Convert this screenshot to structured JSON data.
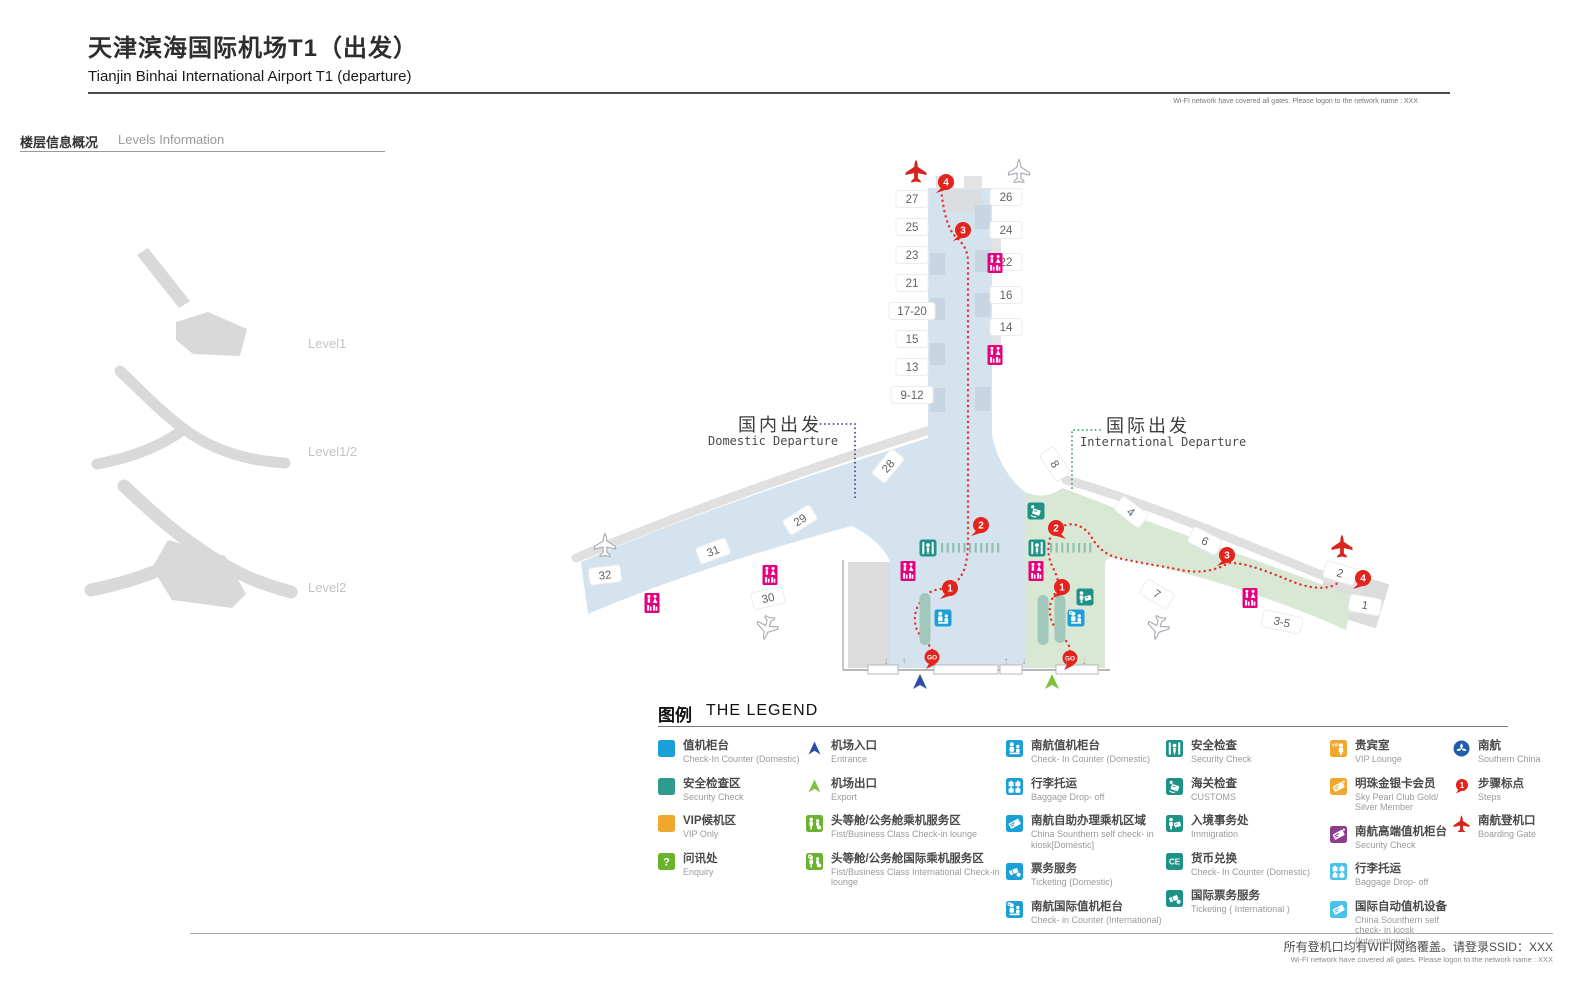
{
  "header": {
    "title_zh": "天津滨海国际机场T1（出发）",
    "title_en": "Tianjin Binhai International Airport T1 (departure)",
    "wifi_note": "Wi-FI network have covered all gates. Please logon to the network name : XXX"
  },
  "levels": {
    "heading_zh": "楼层信息概况",
    "heading_en": "Levels Information",
    "items": [
      {
        "label": "Level1"
      },
      {
        "label": "Level1/2"
      },
      {
        "label": "Level2"
      }
    ]
  },
  "map": {
    "domestic_zh": "国内出发",
    "domestic_en": "Domestic Departure",
    "international_zh": "国际出发",
    "international_en": "International Departure",
    "gates": [
      {
        "id": "27",
        "x": 912,
        "y": 199,
        "rot": 0
      },
      {
        "id": "25",
        "x": 912,
        "y": 227,
        "rot": 0
      },
      {
        "id": "23",
        "x": 912,
        "y": 255,
        "rot": 0
      },
      {
        "id": "21",
        "x": 912,
        "y": 283,
        "rot": 0
      },
      {
        "id": "17-20",
        "x": 912,
        "y": 311,
        "rot": 0,
        "w": 46
      },
      {
        "id": "15",
        "x": 912,
        "y": 339,
        "rot": 0
      },
      {
        "id": "13",
        "x": 912,
        "y": 367,
        "rot": 0
      },
      {
        "id": "9-12",
        "x": 912,
        "y": 395,
        "rot": 0,
        "w": 42
      },
      {
        "id": "26",
        "x": 1006,
        "y": 197,
        "rot": 0
      },
      {
        "id": "24",
        "x": 1006,
        "y": 230,
        "rot": 0
      },
      {
        "id": "22",
        "x": 1006,
        "y": 262,
        "rot": 0
      },
      {
        "id": "16",
        "x": 1006,
        "y": 295,
        "rot": 0
      },
      {
        "id": "14",
        "x": 1006,
        "y": 327,
        "rot": 0
      },
      {
        "id": "28",
        "x": 888,
        "y": 466,
        "rot": -50
      },
      {
        "id": "29",
        "x": 800,
        "y": 520,
        "rot": -32
      },
      {
        "id": "31",
        "x": 713,
        "y": 551,
        "rot": -20
      },
      {
        "id": "32",
        "x": 605,
        "y": 575,
        "rot": -7
      },
      {
        "id": "30",
        "x": 768,
        "y": 598,
        "rot": -14
      },
      {
        "id": "8",
        "x": 1055,
        "y": 464,
        "rot": 56
      },
      {
        "id": "4",
        "x": 1131,
        "y": 512,
        "rot": 38
      },
      {
        "id": "6",
        "x": 1205,
        "y": 541,
        "rot": 27
      },
      {
        "id": "2",
        "x": 1340,
        "y": 573,
        "rot": 16
      },
      {
        "id": "7",
        "x": 1157,
        "y": 594,
        "rot": 31
      },
      {
        "id": "3-5",
        "x": 1282,
        "y": 622,
        "rot": 12,
        "w": 40
      },
      {
        "id": "1",
        "x": 1365,
        "y": 605,
        "rot": 10
      }
    ],
    "icons": [
      {
        "type": "toilet",
        "x": 995,
        "y": 263
      },
      {
        "type": "toilet",
        "x": 995,
        "y": 355
      },
      {
        "type": "toilet",
        "x": 908,
        "y": 571
      },
      {
        "type": "toilet",
        "x": 1036,
        "y": 571
      },
      {
        "type": "toilet",
        "x": 770,
        "y": 575
      },
      {
        "type": "toilet",
        "x": 652,
        "y": 603
      },
      {
        "type": "toilet",
        "x": 1250,
        "y": 598
      },
      {
        "type": "security",
        "x": 928,
        "y": 548
      },
      {
        "type": "security",
        "x": 1037,
        "y": 548
      },
      {
        "type": "customs",
        "x": 1036,
        "y": 511
      },
      {
        "type": "immigration",
        "x": 1085,
        "y": 597
      },
      {
        "type": "checkin_dom",
        "x": 943,
        "y": 618
      },
      {
        "type": "checkin_intl",
        "x": 1076,
        "y": 618
      },
      {
        "type": "island",
        "x": 925,
        "y": 619,
        "h": 52
      },
      {
        "type": "island",
        "x": 1043,
        "y": 620,
        "h": 50
      },
      {
        "type": "island",
        "x": 1060,
        "y": 619,
        "h": 48
      }
    ],
    "security_channels": [
      {
        "x": 941,
        "y": 543,
        "count": 11
      },
      {
        "x": 1050,
        "y": 543,
        "count": 8
      }
    ],
    "steps": [
      {
        "n": "1",
        "x": 950,
        "y": 588,
        "tail": "l",
        "zone": "domestic"
      },
      {
        "n": "2",
        "x": 981,
        "y": 525,
        "tail": "l",
        "zone": "domestic"
      },
      {
        "n": "3",
        "x": 963,
        "y": 230,
        "tail": "l",
        "zone": "domestic"
      },
      {
        "n": "4",
        "x": 946,
        "y": 182,
        "tail": "l",
        "zone": "domestic"
      },
      {
        "n": "1",
        "x": 1062,
        "y": 587,
        "tail": "l",
        "zone": "international"
      },
      {
        "n": "2",
        "x": 1056,
        "y": 528,
        "tail": "r",
        "zone": "international"
      },
      {
        "n": "3",
        "x": 1227,
        "y": 555,
        "tail": "l",
        "zone": "international"
      },
      {
        "n": "4",
        "x": 1363,
        "y": 578,
        "tail": "l",
        "zone": "international"
      }
    ],
    "go_markers": [
      {
        "x": 932,
        "y": 657,
        "label": "GO",
        "zone": "domestic"
      },
      {
        "x": 1070,
        "y": 658,
        "label": "GO",
        "zone": "international"
      }
    ],
    "planes": [
      {
        "x": 916,
        "y": 171,
        "rot": 0,
        "c": "red"
      },
      {
        "x": 1342,
        "y": 546,
        "rot": 0,
        "c": "red"
      },
      {
        "x": 1019,
        "y": 171,
        "rot": 0,
        "c": "gray"
      },
      {
        "x": 605,
        "y": 545,
        "rot": 0,
        "c": "gray"
      },
      {
        "x": 767,
        "y": 628,
        "rot": 195,
        "c": "gray"
      },
      {
        "x": 1158,
        "y": 628,
        "rot": 195,
        "c": "gray"
      }
    ],
    "entrances": [
      {
        "x": 920,
        "y": 683,
        "c": "#2b4ea2",
        "name": "entrance-arrow-domestic"
      },
      {
        "x": 1052,
        "y": 683,
        "c": "#7fc13d",
        "name": "entrance-arrow-international"
      }
    ],
    "door_arrows": [
      {
        "x": 886,
        "y": 664,
        "dir": "d"
      },
      {
        "x": 904,
        "y": 664,
        "dir": "u"
      },
      {
        "x": 1006,
        "y": 664,
        "dir": "u"
      },
      {
        "x": 1024,
        "y": 664,
        "dir": "d"
      },
      {
        "x": 1066,
        "y": 664,
        "dir": "u"
      },
      {
        "x": 1084,
        "y": 664,
        "dir": "d"
      }
    ],
    "routes": {
      "domestic": "M932,650 C928,641 916,636 915,622 C914,606 922,600 928,594 C935,587 944,591 951,586 C959,581 964,573 966,563 C968,553 968,545 968,535 L968,262 C968,248 961,242 955,236 C949,230 945,216 943,204 L941,190",
      "international": "M1070,651 C1070,641 1059,636 1053,624 C1047,612 1050,600 1056,592 C1060,586 1058,578 1054,570 C1050,562 1047,554 1049,542 C1051,532 1058,527 1066,525 C1077,522 1087,529 1092,538 C1097,547 1106,555 1118,558 C1140,563 1161,566 1181,570 C1201,574 1216,570 1229,563 C1245,562 1271,573 1296,583 C1316,590 1331,589 1339,582 C1345,577 1351,575 1357,575"
    },
    "connectors": {
      "domestic": "M812,424 L855,424 L855,500",
      "international": "M1100,430 L1072,430 L1072,489"
    }
  },
  "legend": {
    "title_zh": "图例",
    "title_en": "THE LEGEND",
    "columns": [
      [
        {
          "icon": "sq_blue",
          "zh": "值机柜台",
          "en": "Check-In Counter (Domestic)"
        },
        {
          "icon": "sq_teal",
          "zh": "安全检查区",
          "en": "Security Check"
        },
        {
          "icon": "sq_orange",
          "zh": "VIP候机区",
          "en": "VIP Only"
        },
        {
          "icon": "enquiry",
          "zh": "问讯处",
          "en": "Enquiry"
        }
      ],
      [
        {
          "icon": "arrow_blue",
          "zh": "机场入口",
          "en": "Entrance"
        },
        {
          "icon": "arrow_green",
          "zh": "机场出口",
          "en": "Export"
        },
        {
          "icon": "fb_lounge",
          "zh": "头等舱/公务舱乘机服务区",
          "en": "Fist/Business Class Check-in lounge"
        },
        {
          "icon": "fb_lounge_intl",
          "zh": "头等舱/公务舱国际乘机服务区",
          "en": "Fist/Business Class International Check-in lounge"
        }
      ],
      [
        {
          "icon": "checkin_dom",
          "zh": "南航值机柜台",
          "en": "Check- In Counter (Domestic)"
        },
        {
          "icon": "baggage_blue",
          "zh": "行李托运",
          "en": "Baggage Drop- off"
        },
        {
          "icon": "kiosk_blue",
          "zh": "南航自助办理乘机区域",
          "en": "China Sounthern self check- in kiosk[Domestic]"
        },
        {
          "icon": "ticket_blue",
          "zh": "票务服务",
          "en": "Ticketing (Domestic)"
        },
        {
          "icon": "checkin_intl",
          "zh": "南航国际值机柜台",
          "en": "Check- in Counter (International)"
        }
      ],
      [
        {
          "icon": "security",
          "zh": "安全检查",
          "en": "Security Check"
        },
        {
          "icon": "customs",
          "zh": "海关检查",
          "en": "CUSTOMS"
        },
        {
          "icon": "immigration",
          "zh": "入境事务处",
          "en": "Immigration"
        },
        {
          "icon": "ce",
          "zh": "货币兑换",
          "en": "Check- In Counter (Domestic)"
        },
        {
          "icon": "ticket_teal",
          "zh": "国际票务服务",
          "en": "Ticketing ( International )"
        }
      ],
      [
        {
          "icon": "vip_lounge",
          "zh": "贵宾室",
          "en": "VIP Lounge"
        },
        {
          "icon": "pearl_card",
          "zh": "明珠金银卡会员",
          "en": "Sky Pearl Club Gold/ Silver Member"
        },
        {
          "icon": "premium_checkin",
          "zh": "南航高端值机柜台",
          "en": "Security Check"
        },
        {
          "icon": "baggage_cyan",
          "zh": "行李托运",
          "en": "Baggage Drop- off"
        },
        {
          "icon": "kiosk_cyan",
          "zh": "国际自动值机设备",
          "en": "China Sounthern self check- in kiosk (International)"
        }
      ],
      [
        {
          "icon": "cz_logo",
          "zh": "南航",
          "en": "Southern China"
        },
        {
          "icon": "steps_icon",
          "zh": "步骤标点",
          "en": "Steps"
        },
        {
          "icon": "boarding",
          "zh": "南航登机口",
          "en": "Boarding Gate"
        }
      ]
    ]
  },
  "footer": {
    "wifi_zh": "所有登机口均有WIFI网络覆盖。请登录SSID：XXX",
    "wifi_en": "Wi-FI network have covered all gates. Please logon to the network name : XXX"
  },
  "colors": {
    "cz_blue": "#1b9fd8",
    "teal": "#1f9287",
    "magenta": "#e5007d",
    "red": "#e3231c",
    "orange": "#f0a72e",
    "green": "#6ab32d",
    "purple": "#8e3d8e",
    "cyan": "#49c1e9",
    "domestic_fill": "#d5e3ef",
    "international_fill": "#d9e8d5"
  }
}
